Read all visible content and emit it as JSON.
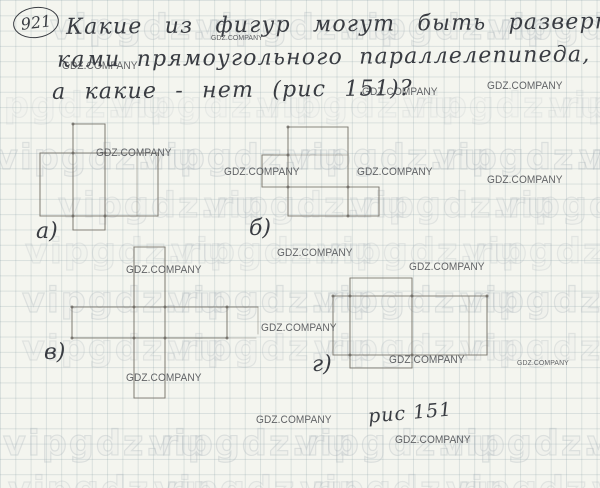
{
  "problem": {
    "number": "921",
    "line1": "Какие из фигур могут быть разверт-",
    "line2": "ками прямоугольного параллелепипеда,",
    "line3": "а какие - нет (рис 151)?"
  },
  "caption": "рис 151",
  "colors": {
    "paper": "#f4f5ef",
    "grid_line": "rgba(125,150,158,0.22)",
    "pencil": "#7b776e",
    "ink": "#393c42",
    "watermark_stroke": "#a5afb6",
    "brand_text": "#54565a"
  },
  "watermarks": {
    "text": "vipgdz.ru",
    "spacing": 146,
    "rows": [
      {
        "y": 8,
        "x0": 50,
        "op": 0.55
      },
      {
        "y": 86,
        "x0": -35,
        "op": 0.3
      },
      {
        "y": 138,
        "x0": -5,
        "op": 0.55
      },
      {
        "y": 186,
        "x0": 58,
        "op": 0.45
      },
      {
        "y": 232,
        "x0": 25,
        "op": 0.4
      },
      {
        "y": 281,
        "x0": 22,
        "op": 0.55
      },
      {
        "y": 329,
        "x0": 22,
        "op": 0.45
      },
      {
        "y": 424,
        "x0": 3,
        "op": 0.55
      },
      {
        "y": 470,
        "x0": 8,
        "op": 0.45
      }
    ]
  },
  "brand_tags": {
    "text": "GDZ.COMPANY",
    "items": [
      {
        "x": 211,
        "y": 33,
        "small": true
      },
      {
        "x": 62,
        "y": 60,
        "small": false
      },
      {
        "x": 362,
        "y": 86,
        "small": false
      },
      {
        "x": 487,
        "y": 80,
        "small": false
      },
      {
        "x": 96,
        "y": 147,
        "small": false
      },
      {
        "x": 224,
        "y": 166,
        "small": false
      },
      {
        "x": 357,
        "y": 166,
        "small": false
      },
      {
        "x": 487,
        "y": 174,
        "small": false
      },
      {
        "x": 277,
        "y": 247,
        "small": false
      },
      {
        "x": 409,
        "y": 261,
        "small": false
      },
      {
        "x": 126,
        "y": 264,
        "small": false
      },
      {
        "x": 261,
        "y": 322,
        "small": false
      },
      {
        "x": 126,
        "y": 372,
        "small": false
      },
      {
        "x": 389,
        "y": 354,
        "small": false
      },
      {
        "x": 517,
        "y": 358,
        "small": true
      },
      {
        "x": 256,
        "y": 414,
        "small": false
      },
      {
        "x": 395,
        "y": 434,
        "small": false
      }
    ]
  },
  "figures": [
    {
      "id": "a",
      "label": "а)",
      "label_x": 36,
      "label_y": 219,
      "lines": [
        [
          73,
          124,
          105,
          124
        ],
        [
          73,
          124,
          73,
          230
        ],
        [
          105,
          124,
          105,
          230
        ],
        [
          73,
          230,
          105,
          230
        ],
        [
          40,
          153,
          158,
          153
        ],
        [
          40,
          153,
          40,
          216
        ],
        [
          158,
          153,
          158,
          216
        ],
        [
          40,
          216,
          158,
          216
        ]
      ],
      "faint_lines": [
        [
          137,
          153,
          137,
          216
        ]
      ],
      "dots": [
        [
          73,
          153
        ],
        [
          105,
          153
        ],
        [
          73,
          216
        ],
        [
          105,
          216
        ],
        [
          73,
          124
        ]
      ]
    },
    {
      "id": "b",
      "label": "б)",
      "label_x": 249,
      "label_y": 216,
      "lines": [
        [
          288,
          127,
          348,
          127
        ],
        [
          288,
          127,
          288,
          216
        ],
        [
          348,
          127,
          348,
          216
        ],
        [
          288,
          216,
          379,
          216
        ],
        [
          262,
          155,
          288,
          155
        ],
        [
          262,
          155,
          262,
          187
        ],
        [
          262,
          187,
          288,
          187
        ],
        [
          288,
          187,
          379,
          187
        ],
        [
          379,
          187,
          379,
          216
        ]
      ],
      "faint_lines": [
        [
          288,
          155,
          348,
          155
        ]
      ],
      "dots": [
        [
          288,
          155
        ],
        [
          288,
          187
        ],
        [
          348,
          187
        ],
        [
          288,
          127
        ],
        [
          348,
          216
        ]
      ]
    },
    {
      "id": "v",
      "label": "в)",
      "label_x": 44,
      "label_y": 340,
      "lines": [
        [
          134,
          247,
          165,
          247
        ],
        [
          134,
          247,
          134,
          398
        ],
        [
          165,
          247,
          165,
          398
        ],
        [
          134,
          398,
          165,
          398
        ],
        [
          72,
          307,
          258,
          307
        ],
        [
          72,
          307,
          72,
          338
        ],
        [
          72,
          338,
          227,
          338
        ],
        [
          227,
          307,
          227,
          338
        ]
      ],
      "faint_lines": [
        [
          258,
          307,
          258,
          334
        ],
        [
          227,
          338,
          256,
          338
        ]
      ],
      "dots": [
        [
          72,
          307
        ],
        [
          72,
          338
        ],
        [
          134,
          307
        ],
        [
          165,
          307
        ],
        [
          134,
          338
        ],
        [
          165,
          338
        ],
        [
          227,
          307
        ],
        [
          227,
          338
        ]
      ]
    },
    {
      "id": "g",
      "label": "г)",
      "label_x": 312,
      "label_y": 352,
      "lines": [
        [
          333,
          296,
          487,
          296
        ],
        [
          333,
          296,
          333,
          355
        ],
        [
          333,
          355,
          487,
          355
        ],
        [
          487,
          296,
          487,
          355
        ],
        [
          350,
          278,
          412,
          278
        ],
        [
          350,
          278,
          350,
          368
        ],
        [
          412,
          278,
          412,
          368
        ],
        [
          350,
          368,
          412,
          368
        ]
      ],
      "faint_lines": [
        [
          469,
          296,
          469,
          355
        ]
      ],
      "dots": [
        [
          350,
          296
        ],
        [
          412,
          296
        ],
        [
          350,
          355
        ],
        [
          412,
          355
        ],
        [
          487,
          296
        ],
        [
          333,
          296
        ]
      ]
    }
  ]
}
